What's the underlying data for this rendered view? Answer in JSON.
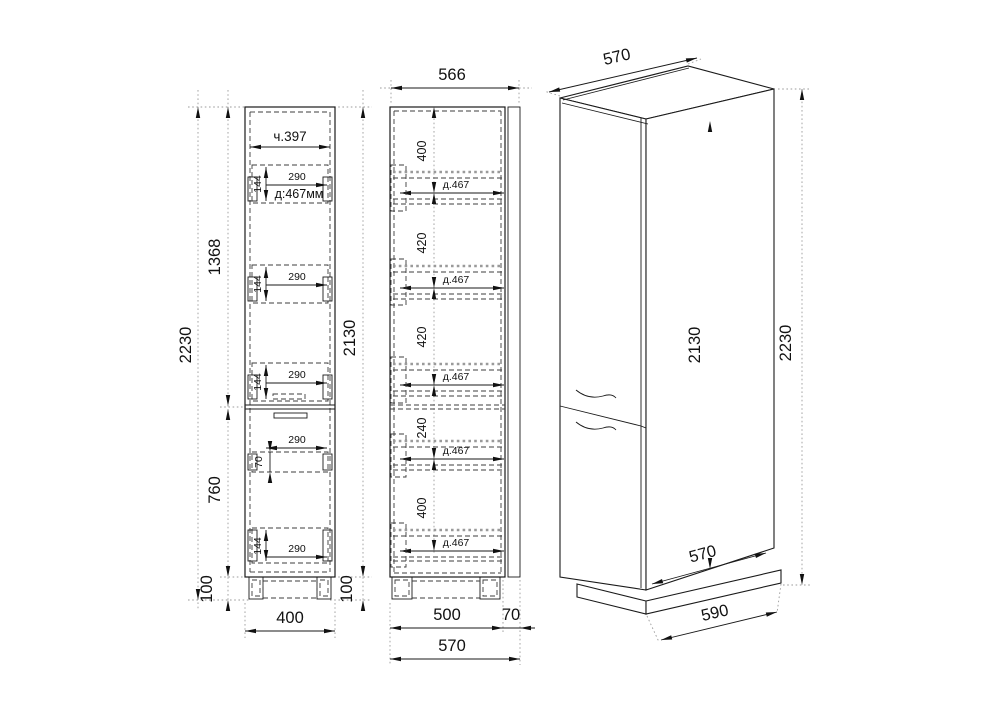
{
  "views": {
    "front": {
      "top_inner_width": "ч.397",
      "total_height": "2230",
      "upper_section": "1368",
      "lower_section": "760",
      "plinth_left": "100",
      "body_height": "2130",
      "plinth_right": "100",
      "width": "400",
      "slides": [
        {
          "w": "290",
          "h": "144",
          "depth": "д:467мм"
        },
        {
          "w": "290",
          "h": "144"
        },
        {
          "w": "290",
          "h": "144"
        },
        {
          "w": "290",
          "h": "70"
        },
        {
          "w": "290",
          "h": "144"
        }
      ]
    },
    "side": {
      "top_width": "566",
      "chain": [
        "400",
        "420",
        "420",
        "240",
        "400"
      ],
      "shelves": [
        "д.467",
        "д.467",
        "д.467",
        "д.467",
        "д.467"
      ],
      "bottom_body": "500",
      "bottom_door": "70",
      "bottom_total": "570"
    },
    "iso": {
      "top_depth": "570",
      "body_height": "2130",
      "total_height": "2230",
      "bottom_depth": "570",
      "plinth_depth": "590"
    }
  }
}
